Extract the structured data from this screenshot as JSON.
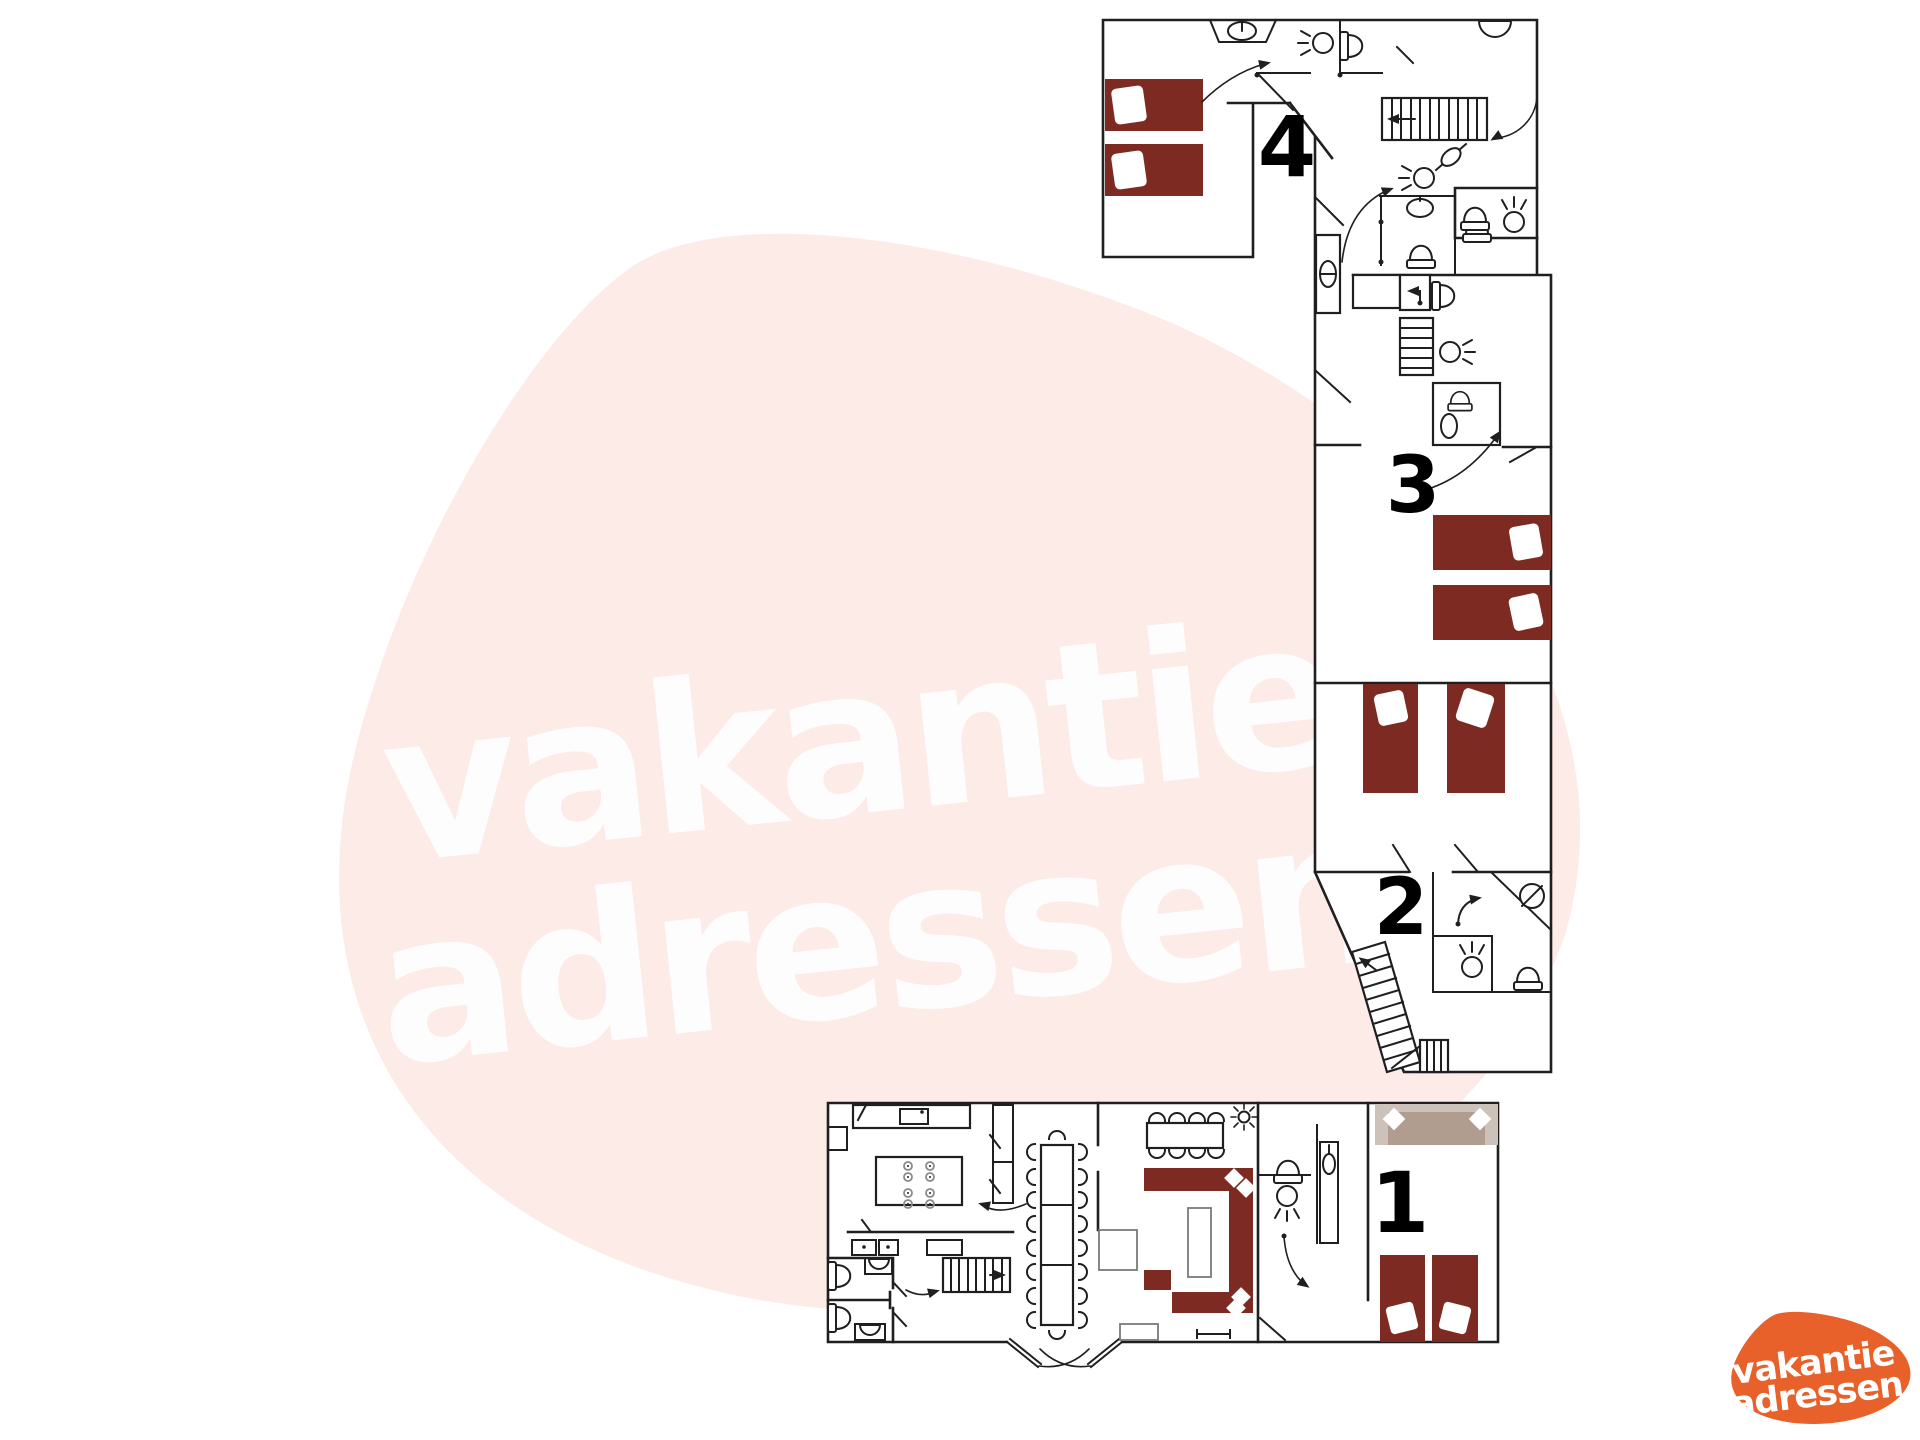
{
  "page": {
    "background": "#ffffff",
    "content": "multi-level holiday home floor plan"
  },
  "watermark": {
    "line1": "vakantie",
    "line2": "adressen",
    "blob_color": "#fcebe7",
    "text_color": "#ffffff"
  },
  "logo": {
    "line1": "vakantie",
    "line2": "adressen",
    "blob_color": "#e8612a",
    "text_color": "#ffffff"
  },
  "floors": [
    {
      "label": "1"
    },
    {
      "label": "2"
    },
    {
      "label": "3"
    },
    {
      "label": "4"
    }
  ],
  "colors": {
    "wall": "#1f1f1f",
    "single_bed": "#7d2a22",
    "pillow": "#ffffff",
    "double_bed_outer": "#cdc2ba",
    "double_bed_inner": "#b19c90"
  },
  "icons": [
    "toilet-icon",
    "sink-icon",
    "ceiling-light-icon",
    "shower-arrow-icon",
    "stairs-icon",
    "door-swing-icon",
    "sun-light-icon",
    "chair-icon",
    "stove-burner-icon",
    "arrow-icon"
  ]
}
